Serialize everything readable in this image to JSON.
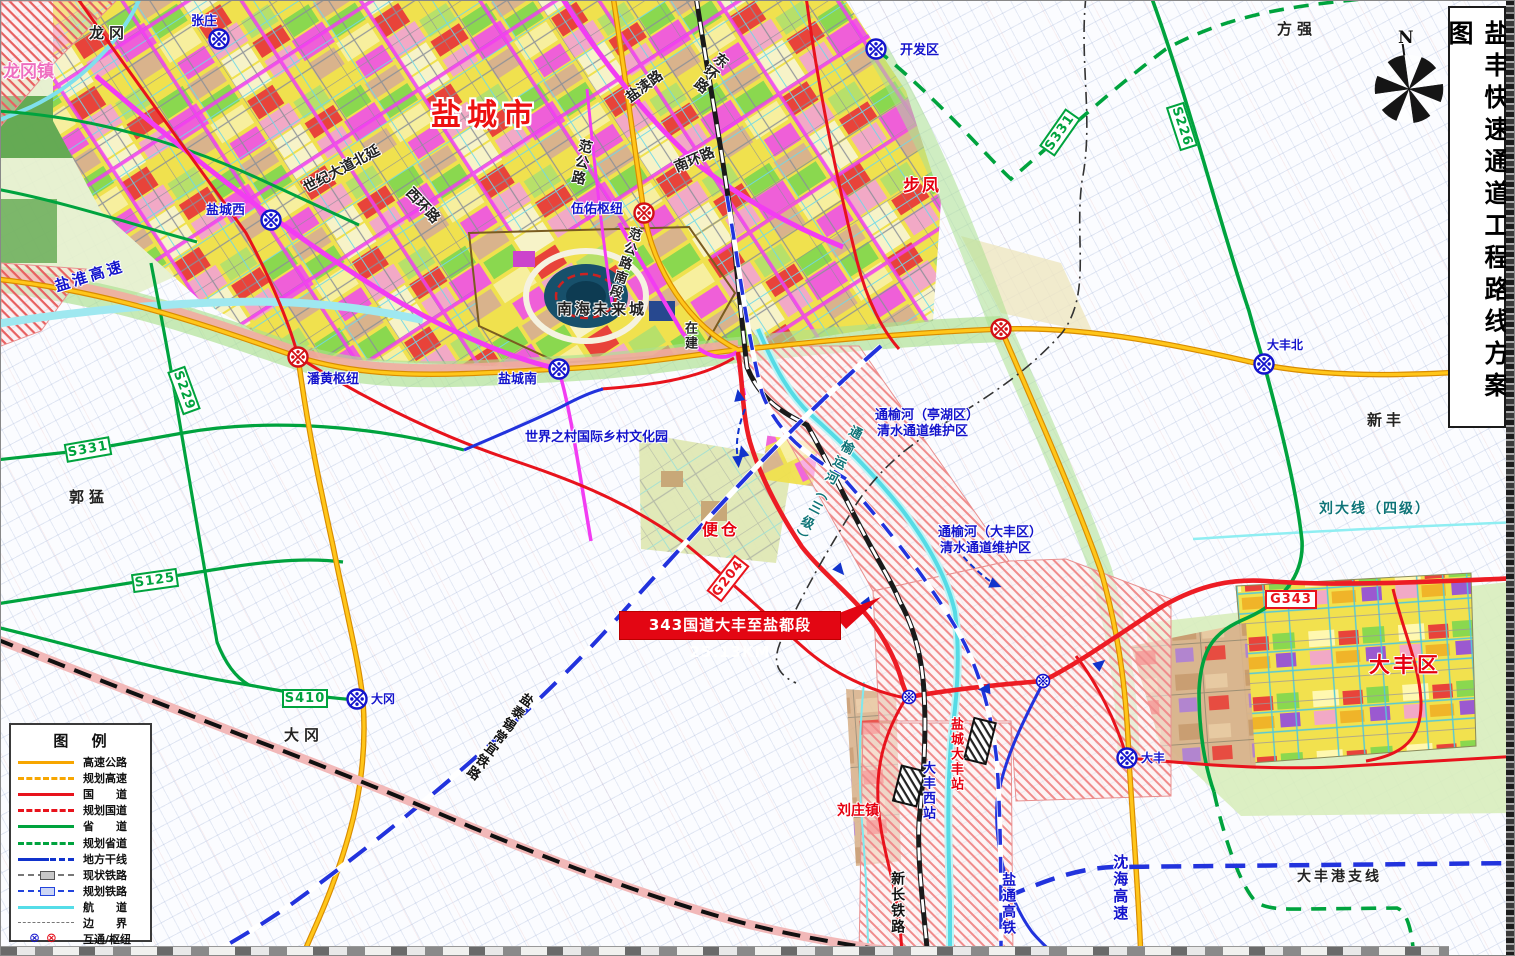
{
  "title": {
    "text": "盐丰快速通道工程路线方案图"
  },
  "compass": {
    "north": "N"
  },
  "callout": {
    "text": "343国道大丰至盐都段 25.13KM"
  },
  "legend": {
    "title": "图 例",
    "items": [
      {
        "label": "高速公路",
        "type": "expressway"
      },
      {
        "label": "规划高速",
        "type": "planned-expressway"
      },
      {
        "label": "国　　道",
        "type": "national-road"
      },
      {
        "label": "规划国道",
        "type": "planned-national-road"
      },
      {
        "label": "省　　道",
        "type": "provincial-road"
      },
      {
        "label": "规划省道",
        "type": "planned-provincial-road"
      },
      {
        "label": "地方干线",
        "type": "local-trunk"
      },
      {
        "label": "现状铁路",
        "type": "existing-railway"
      },
      {
        "label": "规划铁路",
        "type": "planned-railway"
      },
      {
        "label": "航　　道",
        "type": "waterway"
      },
      {
        "label": "边　　界",
        "type": "boundary"
      },
      {
        "label": "互通/枢纽",
        "type": "interchange"
      }
    ],
    "interchange_glyph": "⊗"
  },
  "colors": {
    "expressway": "#f7a600",
    "national_road": "#e8131c",
    "provincial_road": "#00a33e",
    "local_trunk": "#1133cc",
    "waterway": "#55dde8",
    "protect_zone_hatch": "#f08c8c",
    "project_route": "#ed1c24"
  },
  "map_labels": {
    "yancheng_city": "盐城市",
    "dafeng_district": "大丰区",
    "longgang": "龙冈",
    "longgang_town": "龙冈镇",
    "zhangzhuang": "张庄",
    "yancheng_west": "盐城西",
    "wuyou_hub": "伍佑枢纽",
    "panhuang_hub": "潘黄枢纽",
    "yancheng_south": "盐城南",
    "kaifaqu": "开发区",
    "bufeng": "步凤",
    "fangqiang": "方强",
    "guomeng": "郭猛",
    "dagang_town": "大冈",
    "dagang_ic": "大冈",
    "dafeng_north": "大丰北",
    "xinfeng": "新丰",
    "dafeng_ic": "大丰",
    "biancang": "便仓",
    "liuzhuang_town": "刘庄镇",
    "shiji_avenue": "世纪大道北延",
    "xihuan_road": "西环路",
    "fangong_road": "范公路",
    "yandu_road": "盐渎路",
    "donghuan_road": "东环路",
    "nanhuan_road": "南环路",
    "fangong_south": "范公路南段",
    "under_construction": "在建",
    "nanhai_city": "南海未来城",
    "world_village": "世界之村国际乡村文化园",
    "tongyu_tinghu_line1": "通榆河（亭湖区）",
    "tongyu_tinghu_line2": "清水通道维护区",
    "tongyu_dafeng_line1": "通榆河（大丰区）",
    "tongyu_dafeng_line2": "清水通道维护区",
    "tongyu_canal": "通榆运河（三级）",
    "yanhuai_expressway": "盐淮高速",
    "shenhai_expressway": "沈海高速",
    "xinchang_railway": "新长铁路",
    "yantong_hsr": "盐通高铁",
    "yantai_railway": "盐泰锡常宜铁路",
    "dafenggang_branch": "大丰港支线",
    "liuda_line": "刘大线（四级）",
    "dafeng_west_station": "大丰西站",
    "yancheng_dafeng_station": "盐城大丰站",
    "shield_s229": "S229",
    "shield_s331_left": "S331",
    "shield_s331_ne": "S331",
    "shield_s125": "S125",
    "shield_s410": "S410",
    "shield_s226": "S226",
    "shield_g204": "G204",
    "shield_g343": "G343"
  }
}
